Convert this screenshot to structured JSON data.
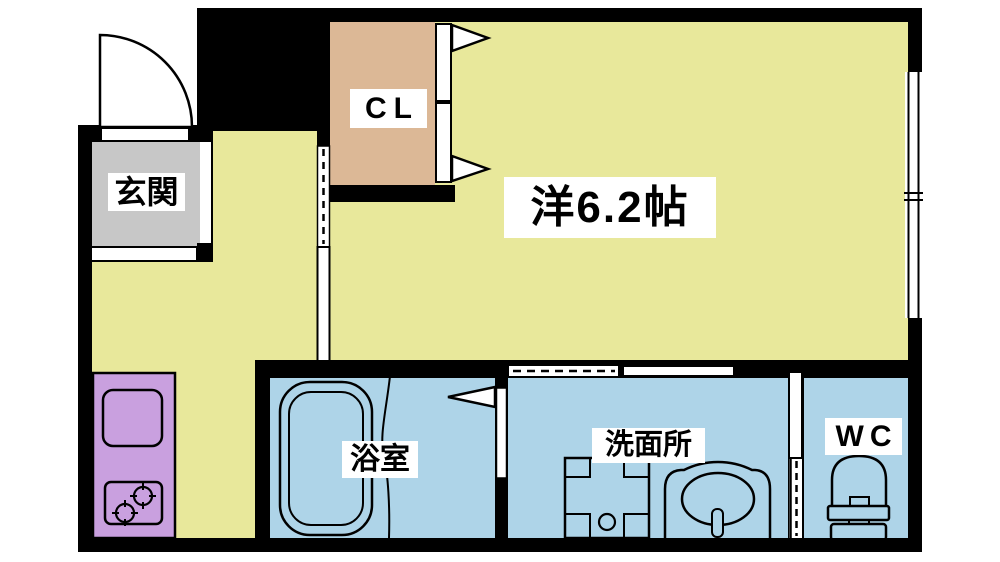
{
  "rooms": {
    "genkan": {
      "label": "玄関"
    },
    "closet": {
      "label": "CL"
    },
    "main": {
      "label": "洋6.2帖"
    },
    "bathroom": {
      "label": "浴室"
    },
    "washroom": {
      "label": "洗面所"
    },
    "wc": {
      "label": "WC"
    }
  },
  "colors": {
    "floor": "#e8e89b",
    "genkan-floor": "#c7c7c7",
    "closet-floor": "#dcb896",
    "kitchen-unit": "#c9a0df",
    "wet-floor": "#aed4e8",
    "wall": "#000000",
    "label-bg": "#ffffff",
    "label-text": "#000000",
    "outside": "#ffffff"
  }
}
